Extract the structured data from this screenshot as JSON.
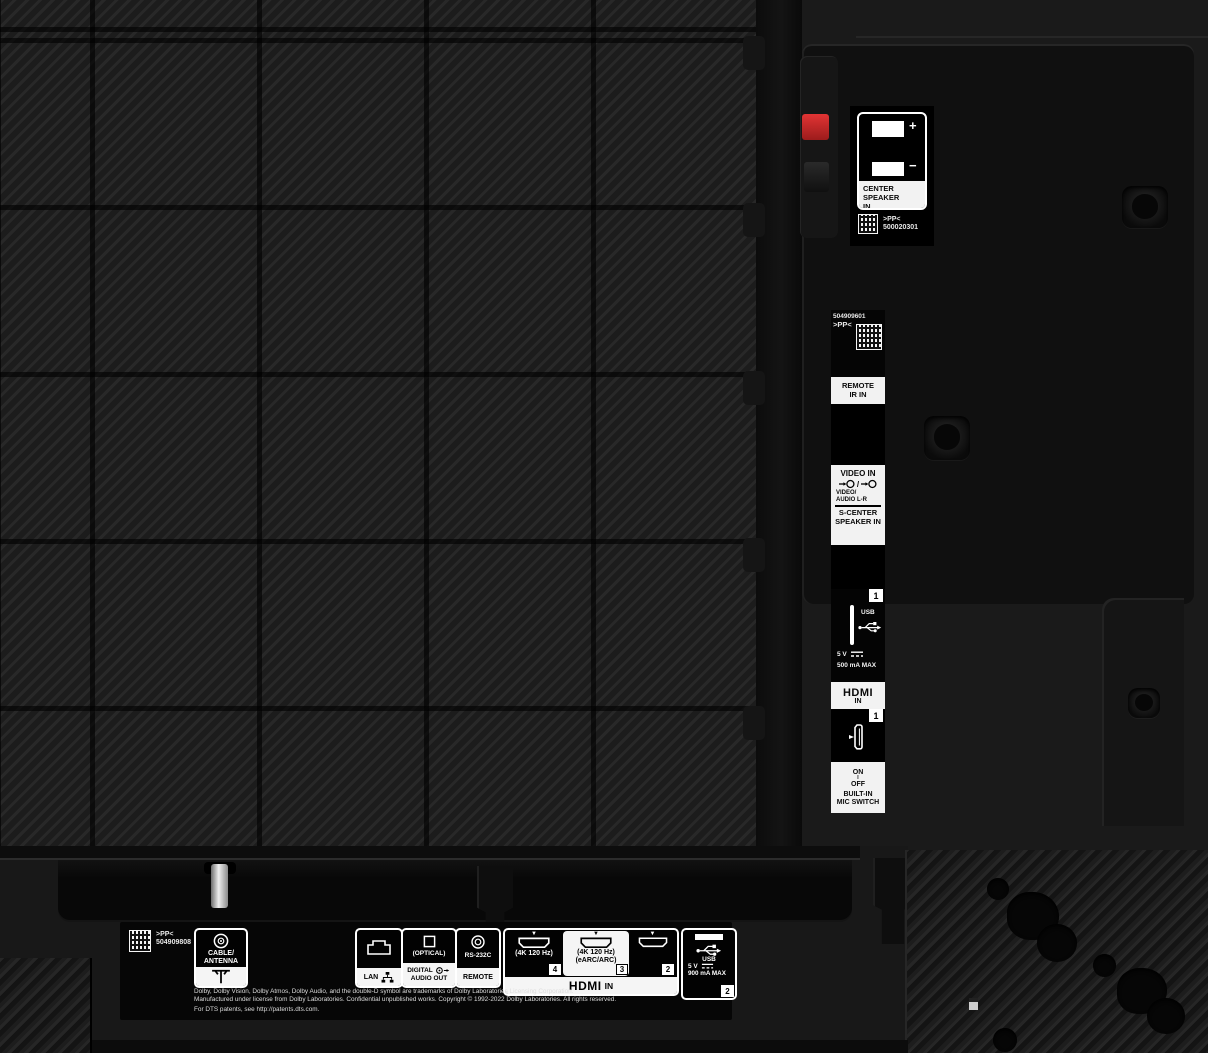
{
  "colors": {
    "panel_dark": "#171717",
    "label_white": "#f2f2f2",
    "label_black": "#050505",
    "terminal_red_clip": "#cf2b2b"
  },
  "icons": {
    "hdmi_marker": "▼"
  },
  "speaker_terminal": {
    "label_line1": "CENTER SPEAKER",
    "label_line2": "IN",
    "plus": "+",
    "minus": "−",
    "pp": ">PP<",
    "code": "500020301"
  },
  "side_column": {
    "serial": "504909601",
    "pp": ">PP<",
    "remote_line1": "REMOTE",
    "remote_line2": "IR IN",
    "video_title": "VIDEO IN",
    "video_slash": "/",
    "video_sub1": "VIDEO/",
    "video_sub2": "AUDIO L-R",
    "scenter_line1": "S-CENTER",
    "scenter_line2": "SPEAKER IN",
    "usb_badge": "1",
    "usb_label": "USB",
    "usb_volt": "5 V",
    "usb_current": "500 mA MAX",
    "hdmi_logo": "HDMI",
    "hdmi_in": "IN",
    "hdmi_badge": "1",
    "mic_on": "ON",
    "mic_mark": "I",
    "mic_off": "OFF",
    "mic_line1": "BUILT-IN",
    "mic_line2": "MIC SWITCH"
  },
  "bottom_panel": {
    "pp": ">PP<",
    "serial": "504909808",
    "cable_line1": "CABLE/",
    "cable_line2": "ANTENNA",
    "lan_label": "LAN",
    "optical_jack": "(OPTICAL)",
    "optical_line1": "DIGITAL",
    "optical_line2": "AUDIO OUT",
    "rs232_label": "RS-232C",
    "rs232_strip": "REMOTE",
    "hdmi4_spec": "(4K 120 Hz)",
    "hdmi4_badge": "4",
    "hdmi3_spec1": "(4K 120 Hz)",
    "hdmi3_spec2": "(eARC/ARC)",
    "hdmi3_badge": "3",
    "hdmi2_badge": "2",
    "hdmi_logo": "HDMI",
    "hdmi_in": "IN",
    "usb_label": "USB",
    "usb_volt": "5 V",
    "usb_current": "900 mA MAX",
    "usb_badge": "2",
    "legal": [
      "Dolby, Dolby Vision, Dolby Atmos, Dolby Audio, and the double-D symbol are trademarks of Dolby Laboratories Licensing Corporation.",
      "Manufactured under license from Dolby Laboratories. Confidential unpublished works. Copyright © 1992-2022 Dolby Laboratories. All rights reserved.",
      "For DTS patents, see http://patents.dts.com."
    ]
  }
}
